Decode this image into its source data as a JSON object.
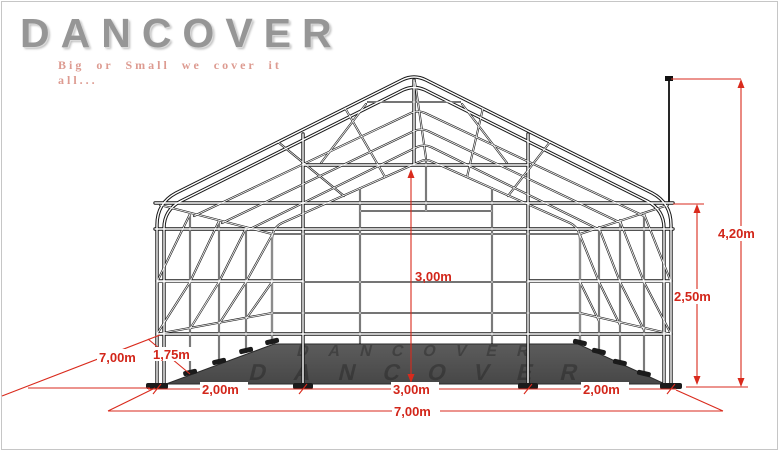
{
  "page": {
    "background": "#ffffff",
    "border_color": "#c6c6c6"
  },
  "logo": {
    "title": "DANCOVER",
    "tagline": "Big or Small we cover it all..."
  },
  "diagram": {
    "type": "storage-tent-frame-perspective-drawing",
    "watermark": "DANCOVER",
    "colors": {
      "dimension_red": "#d92a1c",
      "frame_black": "#181818",
      "floor_gray": "#515151"
    },
    "dimensions": {
      "total_height": "4,20m",
      "eave_height": "2,50m",
      "door_height": "3,00m",
      "left_section_width": "2,00m",
      "door_width": "3,00m",
      "right_section_width": "2,00m",
      "front_total_width": "7,00m",
      "side_depth": "7,00m",
      "bay_spacing": "1,75m"
    }
  }
}
